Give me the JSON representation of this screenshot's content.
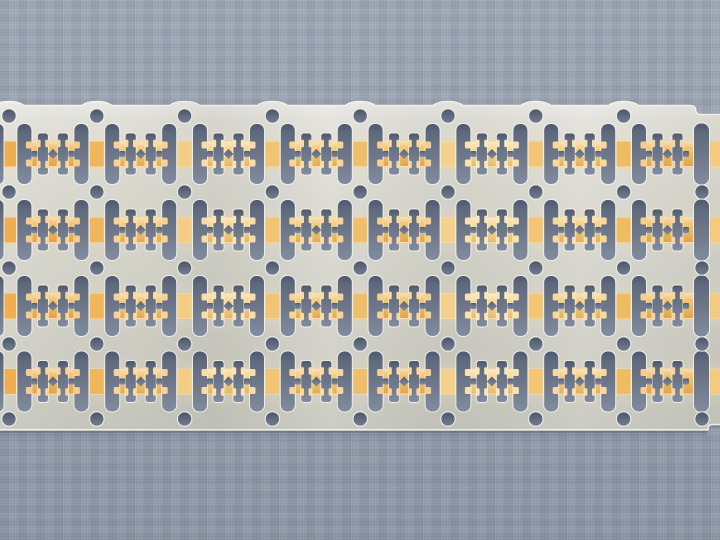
{
  "meta": {
    "title": "Metal lead frame strip on woven gray-blue surface",
    "type": "macro photograph",
    "alt": "Stamped silver-colored semiconductor lead frame strip with four rows of gold-plated lead patterns, round sprocket holes and punched slots, lying horizontally on a blue-gray woven surface"
  },
  "scene": {
    "background": {
      "label": "blue-gray woven mat",
      "base_color": "#97a0af",
      "light_color": "#a3abb9",
      "dark_color": "#8b94a3"
    },
    "strip": {
      "label": "stamped metal lead frame strip",
      "unit_rows": 4,
      "unit_columns": 8,
      "sprocket_hole_rows": 5,
      "sprocket_hole_columns": 9,
      "metal_color": "#d8d7ce",
      "metal_light": "#eceade",
      "metal_dark": "#c8c7be",
      "edge_highlight": "#f4f3ea",
      "cutout_top": "#4e586c",
      "cutout_mid": "#6e7889",
      "cutout_bottom": "#828ca0",
      "hole_top": "#4a5468",
      "hole_mid": "#636d80",
      "hole_bottom": "#737d92",
      "shadow_color": "#3a4458"
    },
    "plating": {
      "label": "gold plating bands",
      "band_count": 4,
      "band_pale": "#efe0ba",
      "band_pale_warm": "#eedcb0",
      "glow_color": "#f2dcaa",
      "cell_tints": [
        "#f2b65a",
        "#f4c169",
        "#f6cf82",
        "#f3c369",
        "#f1bb5e",
        "#f7d68e",
        "#f4c873",
        "#f0b95c"
      ],
      "rail_tints": [
        "#efae52",
        "#f0b65c",
        "#f3cd86",
        "#f1c474",
        "#eec06e",
        "#f4d28c",
        "#f2c674",
        "#f0bc62",
        "#f3ca80"
      ]
    }
  }
}
